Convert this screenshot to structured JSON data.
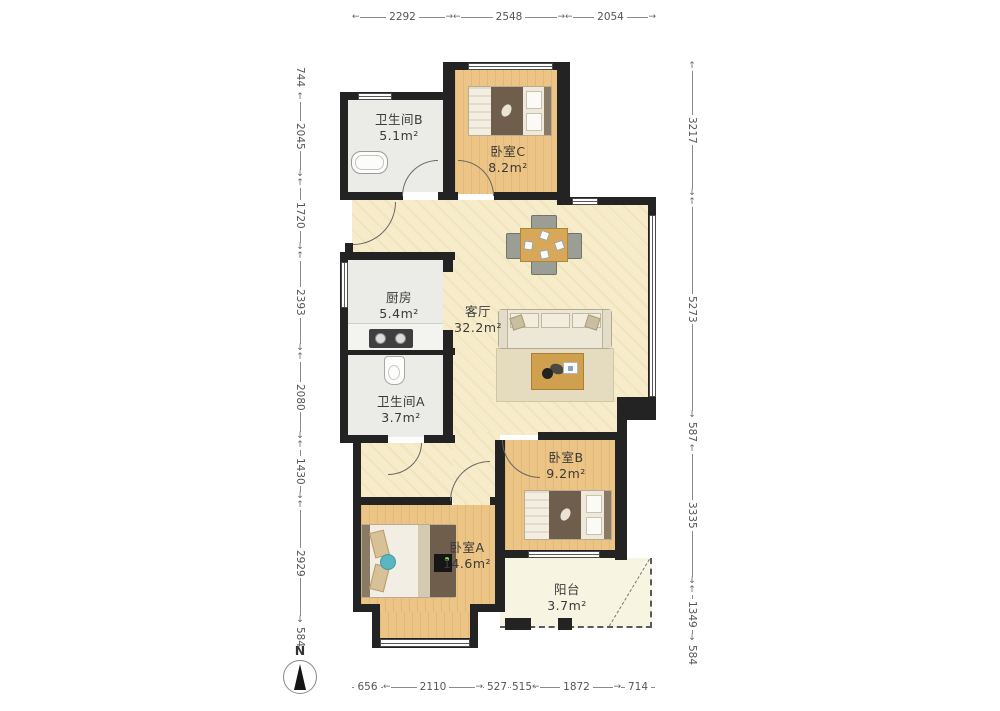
{
  "compass": {
    "label": "N"
  },
  "rooms": [
    {
      "name": "卫生间B",
      "area": "5.1m²"
    },
    {
      "name": "卧室C",
      "area": "8.2m²"
    },
    {
      "name": "厨房",
      "area": "5.4m²"
    },
    {
      "name": "客厅",
      "area": "32.2m²"
    },
    {
      "name": "卫生间A",
      "area": "3.7m²"
    },
    {
      "name": "卧室B",
      "area": "9.2m²"
    },
    {
      "name": "卧室A",
      "area": "14.6m²"
    },
    {
      "name": "阳台",
      "area": "3.7m²"
    }
  ],
  "dimensions_mm": {
    "top": [
      "2292",
      "2548",
      "2054"
    ],
    "left": [
      "744",
      "2045",
      "1720",
      "2393",
      "2080",
      "1430",
      "2929",
      "584"
    ],
    "right": [
      "3217",
      "5273",
      "587",
      "3335",
      "1349",
      "584"
    ],
    "bottom": [
      "656",
      "2110",
      "527",
      "515",
      "1872",
      "714"
    ]
  },
  "colors": {
    "wall": "#232323",
    "bedroom_floor": "#ecc485",
    "living_floor": "#f6ecca",
    "wet_floor": "#ebebe7",
    "balcony_floor": "#f8f4e2",
    "furniture_wood": "#d8a758",
    "dim_text": "#555555"
  }
}
